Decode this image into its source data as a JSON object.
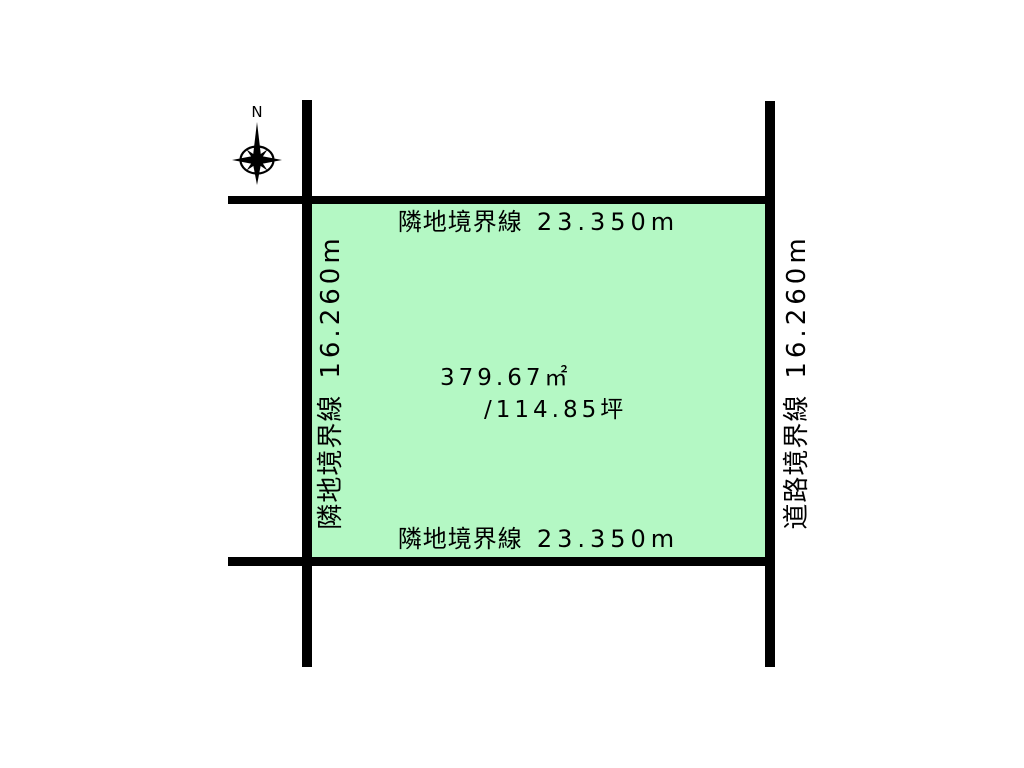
{
  "diagram": {
    "compass": {
      "north_label": "N"
    },
    "plot": {
      "fill_color": "#b4f8c4",
      "line_color": "#000000",
      "area_m2": "379.67㎡",
      "area_tsubo": "/114.85坪",
      "boundaries": {
        "top": {
          "name": "隣地境界線",
          "length": "23.350m"
        },
        "bottom": {
          "name": "隣地境界線",
          "length": "23.350m"
        },
        "left": {
          "name": "隣地境界線",
          "length": "16.260m"
        },
        "right": {
          "name": "道路境界線",
          "length": "16.260m"
        }
      }
    }
  }
}
